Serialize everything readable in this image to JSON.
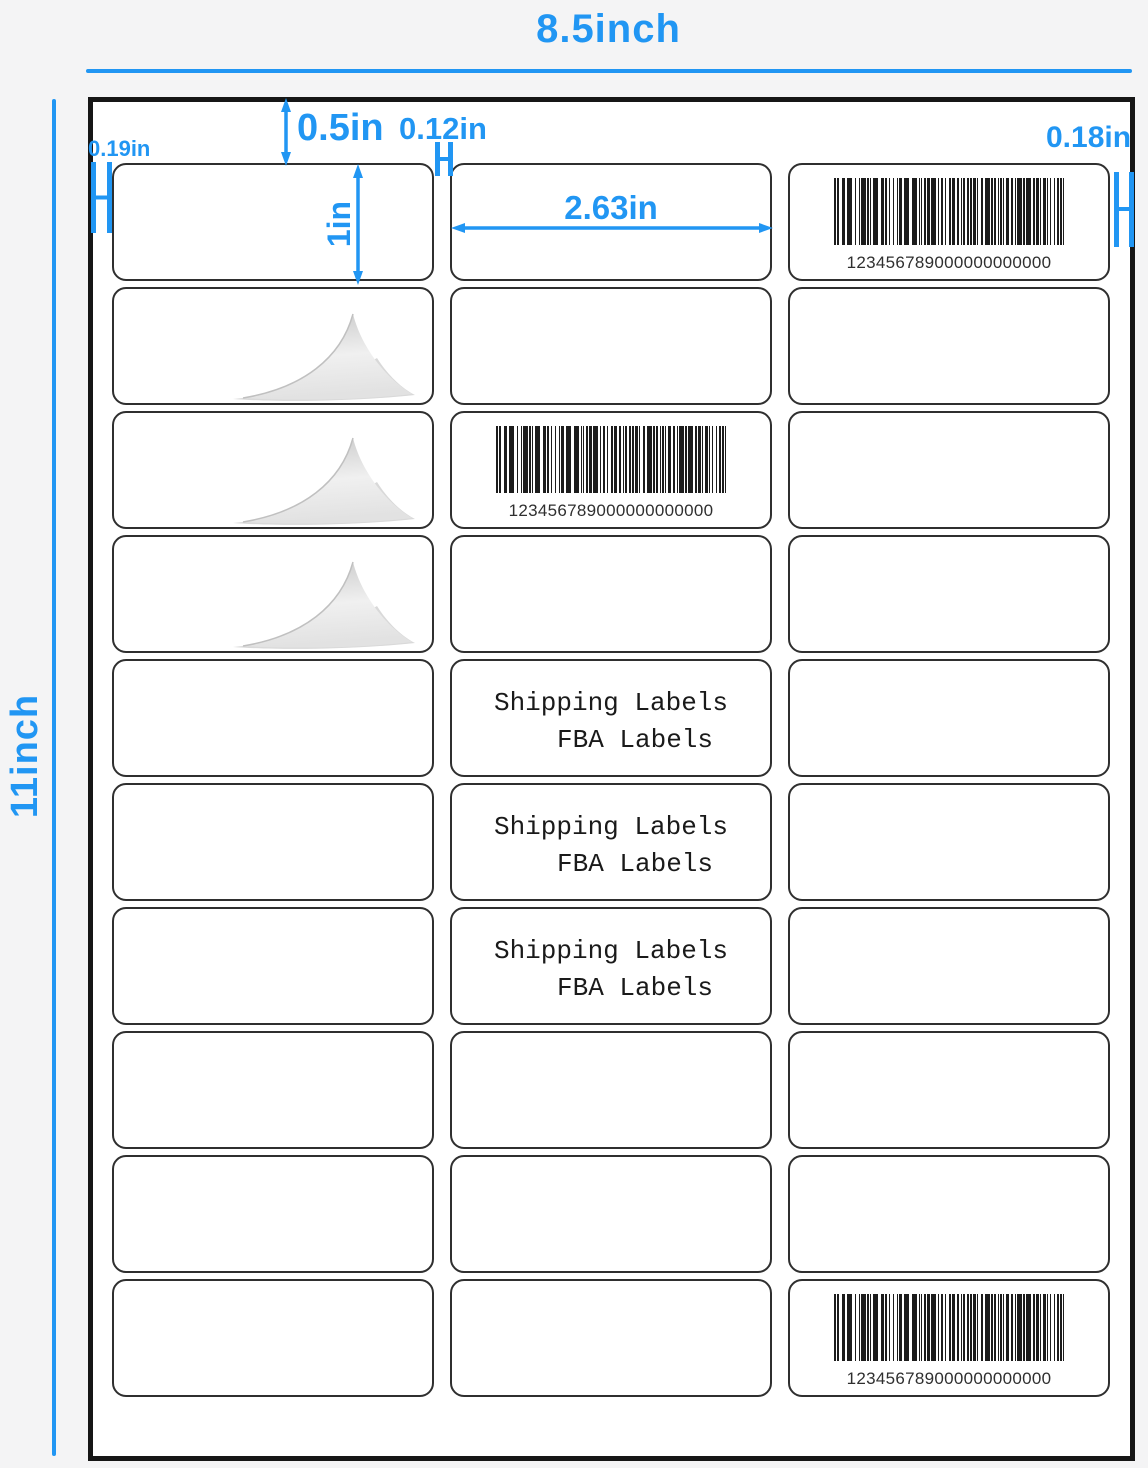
{
  "page": {
    "title_width": "8.5inch",
    "title_height": "11inch"
  },
  "dimensions": {
    "top_margin": "0.5in",
    "side_margin_left": "0.19in",
    "column_gap": "0.12in",
    "side_margin_right": "0.18in",
    "label_height": "1in",
    "label_width": "2.63in"
  },
  "sheet": {
    "rows": 10,
    "columns": 3,
    "barcode_value": "123456789000000000000",
    "label_text_line1": "Shipping Labels",
    "label_text_line2": "FBA Labels",
    "cells": {
      "barcode": [
        {
          "row": 1,
          "col": 3
        },
        {
          "row": 3,
          "col": 2
        },
        {
          "row": 10,
          "col": 3
        }
      ],
      "text": [
        {
          "row": 5,
          "col": 2
        },
        {
          "row": 6,
          "col": 2
        },
        {
          "row": 7,
          "col": 2
        }
      ],
      "peel": [
        {
          "row": 2,
          "col": 1
        },
        {
          "row": 3,
          "col": 1
        },
        {
          "row": 4,
          "col": 1
        }
      ]
    }
  },
  "colors": {
    "accent_blue": "#2196f3",
    "label_border": "#2f2f2f",
    "sheet_border": "#161616",
    "background": "#f4f4f5",
    "barcode_ink": "#1c1c1c"
  }
}
